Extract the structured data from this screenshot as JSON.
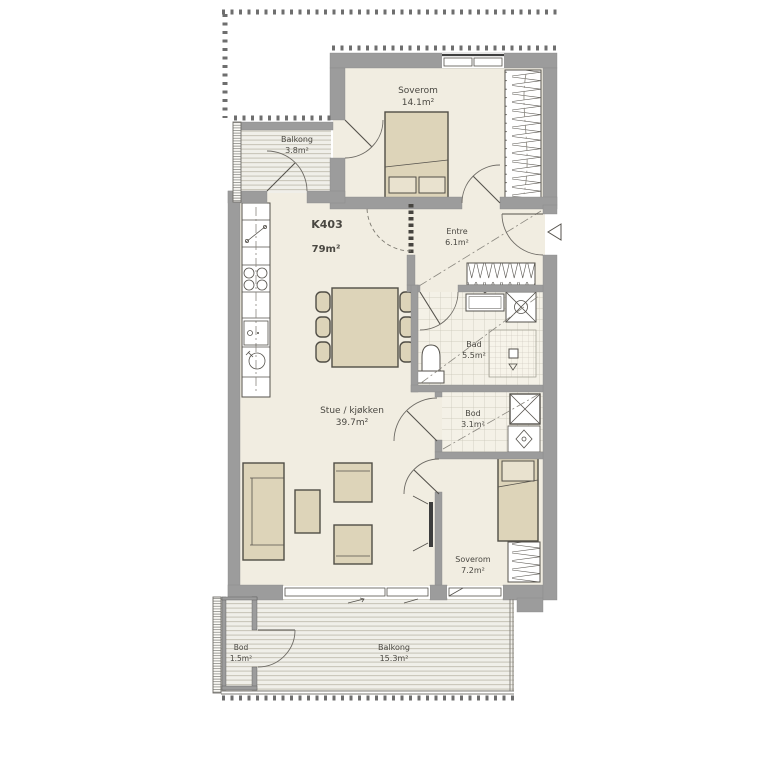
{
  "plan": {
    "unit": {
      "id": "K403",
      "area": "79m²"
    },
    "rooms": {
      "balcony_top": {
        "name": "Balkong",
        "area": "3.8m²"
      },
      "bedroom_main": {
        "name": "Soverom",
        "area": "14.1m²"
      },
      "entre": {
        "name": "Entre",
        "area": "6.1m²"
      },
      "bath": {
        "name": "Bad",
        "area": "5.5m²"
      },
      "living": {
        "name": "Stue / kjøkken",
        "area": "39.7m²"
      },
      "storage": {
        "name": "Bod",
        "area": "3.1m²"
      },
      "bedroom_second": {
        "name": "Soverom",
        "area": "7.2m²"
      },
      "balcony_storage": {
        "name": "Bod",
        "area": "1.5m²"
      },
      "balcony_bottom": {
        "name": "Balkong",
        "area": "15.3m²"
      }
    },
    "colors": {
      "wall": "#9c9c9c",
      "wall_edge": "#8b8b8b",
      "floor": "#f1ede1",
      "furniture": "#ddd4b9",
      "furniture_edge": "#514e46",
      "line": "#55524c",
      "text": "#4a4842",
      "background": "#ffffff"
    }
  }
}
